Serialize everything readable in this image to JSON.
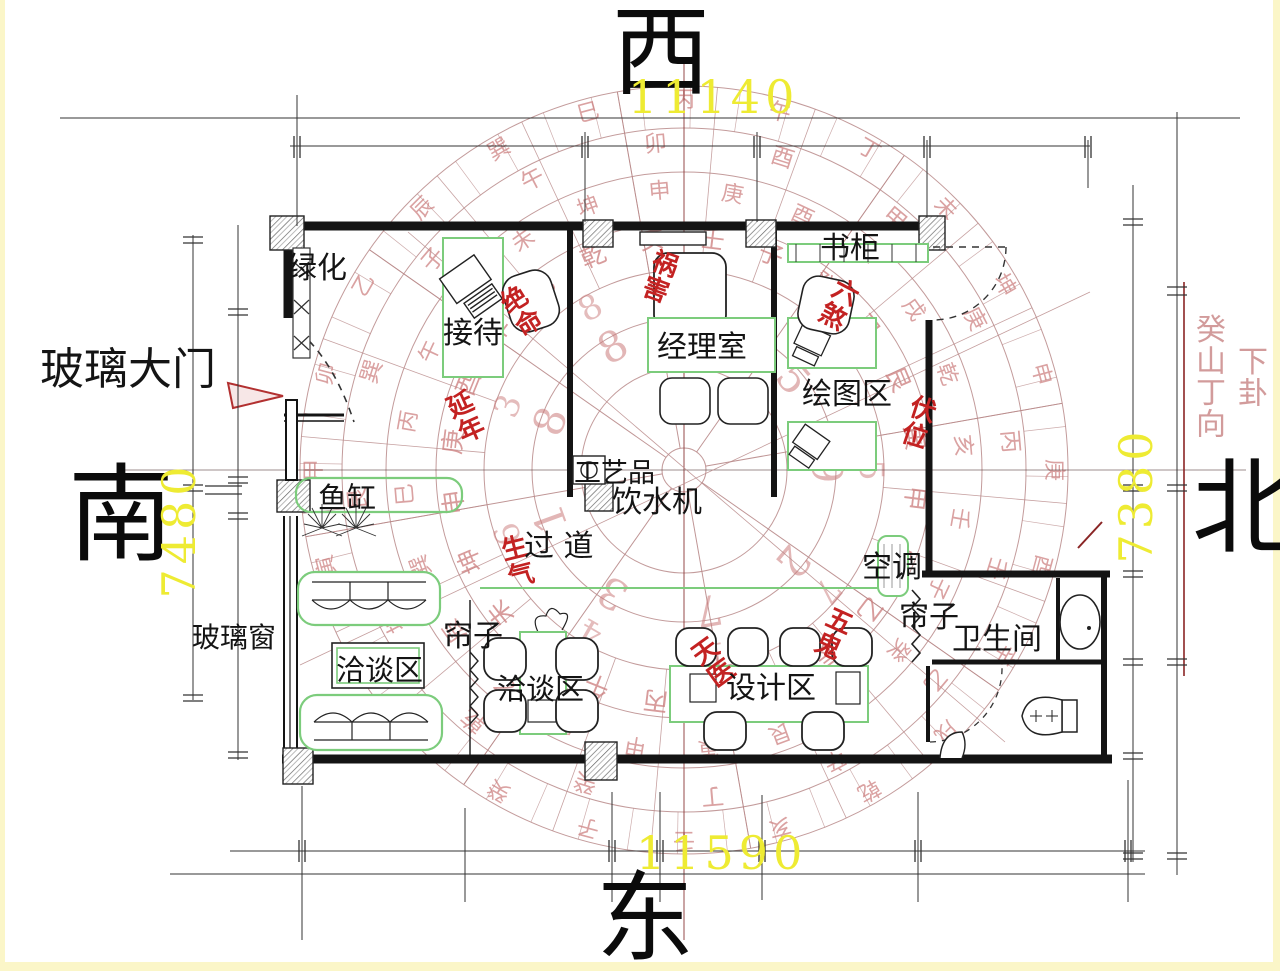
{
  "directions": {
    "west": "西",
    "east": "东",
    "south": "南",
    "north": "北"
  },
  "dims": {
    "top": "11140",
    "bottom": "11590",
    "left": "7480",
    "right": "7380"
  },
  "rooms": {
    "glass_door": "玻璃大门",
    "glass_window": "玻璃窗",
    "greenery": "绿化",
    "reception": "接待",
    "manager_office": "经理室",
    "bookcase": "书柜",
    "drawing_area": "绘图区",
    "crafts": "工艺品",
    "water_dispenser": "饮水机",
    "fish_tank": "鱼缸",
    "corridor": "过 道",
    "air_conditioner": "空调",
    "curtain_mid": "帘子",
    "curtain_right": "帘子",
    "bathroom": "卫生间",
    "meeting_a": "洽谈区",
    "meeting_b": "洽谈区",
    "design_area": "设计区"
  },
  "fengshui_terms": {
    "huohai": "祸害",
    "jueming": "绝命",
    "liusha": "六煞",
    "yannian": "延年",
    "fuwei": "伏位",
    "shengqi": "生气",
    "tianyi": "天医",
    "wugui": "五鬼"
  },
  "annotations": {
    "right_col_1": "癸山丁向",
    "right_col_2": "下卦"
  },
  "compass": {
    "mountains": [
      "壬",
      "子",
      "癸",
      "丑",
      "艮",
      "寅",
      "甲",
      "卯",
      "乙",
      "辰",
      "巽",
      "巳",
      "丙",
      "午",
      "丁",
      "未",
      "坤",
      "申",
      "庚",
      "酉",
      "辛",
      "戌",
      "乾",
      "亥"
    ],
    "numbers_inner": [
      "3",
      "1",
      "8",
      "8",
      "6",
      "5",
      "9",
      "2",
      "7"
    ],
    "numbers_outer": [
      "8",
      "2",
      "9",
      "5",
      "7",
      "1",
      "4",
      "6",
      "3"
    ],
    "stems": [
      "甲",
      "庚",
      "丙",
      "壬",
      "乙",
      "辛",
      "丁",
      "癸",
      "乾",
      "坤",
      "艮",
      "巽",
      "子",
      "午",
      "卯",
      "酉"
    ]
  },
  "colors": {
    "compass_line": "#b98a8a",
    "compass_char": "#cb7b7b",
    "fengshui_red": "#c32222",
    "dimension_yellow": "#eeeb33",
    "furniture_green": "#7ccc7c",
    "wall_black": "#141414",
    "axis_red": "#8a3535"
  }
}
